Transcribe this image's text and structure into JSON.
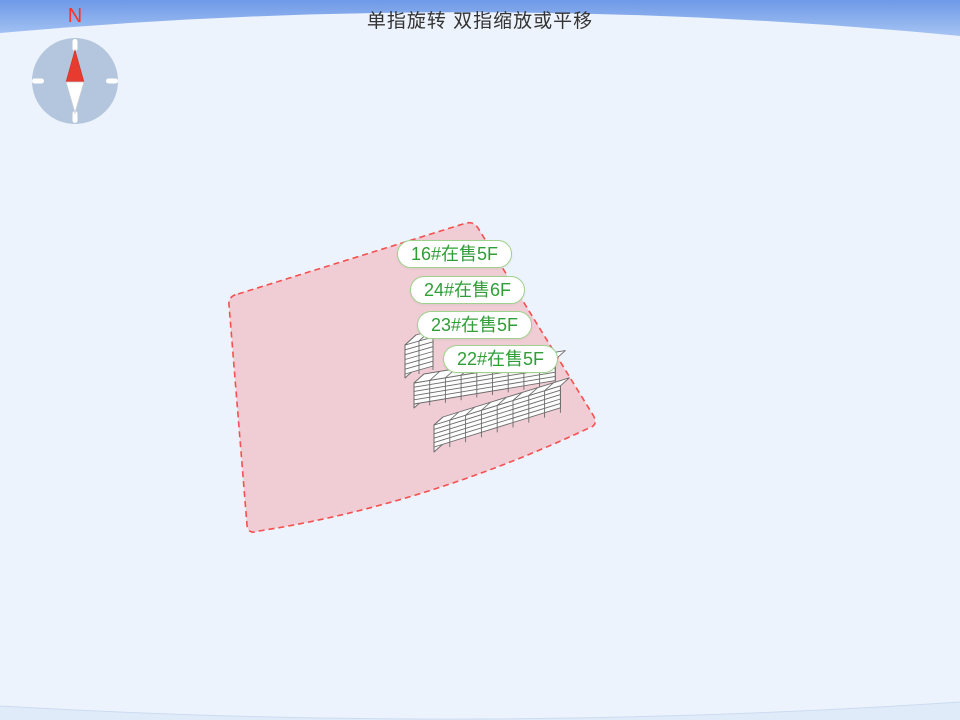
{
  "hint": {
    "gesture_tip": "单指旋转 双指缩放或平移"
  },
  "compass": {
    "north_label": "N"
  },
  "building_labels": [
    {
      "id": "16#",
      "status": "在售",
      "floors": "5F",
      "text": "16#在售5F"
    },
    {
      "id": "24#",
      "status": "在售",
      "floors": "6F",
      "text": "24#在售6F"
    },
    {
      "id": "23#",
      "status": "在售",
      "floors": "5F",
      "text": "23#在售5F"
    },
    {
      "id": "22#",
      "status": "在售",
      "floors": "5F",
      "text": "22#在售5F"
    }
  ],
  "colors": {
    "sky_top": "#6e99e7",
    "sky_bottom": "#a6c4f3",
    "ground": "#edf3fc",
    "parcel_fill": "#f0cdd5",
    "parcel_border": "#f4504f",
    "label_text_green": "#2f9e36",
    "label_border_green": "#9ed18d",
    "north_red": "#ff3226",
    "compass_disc": "#aec2da",
    "needle_red": "#e73b2f"
  }
}
